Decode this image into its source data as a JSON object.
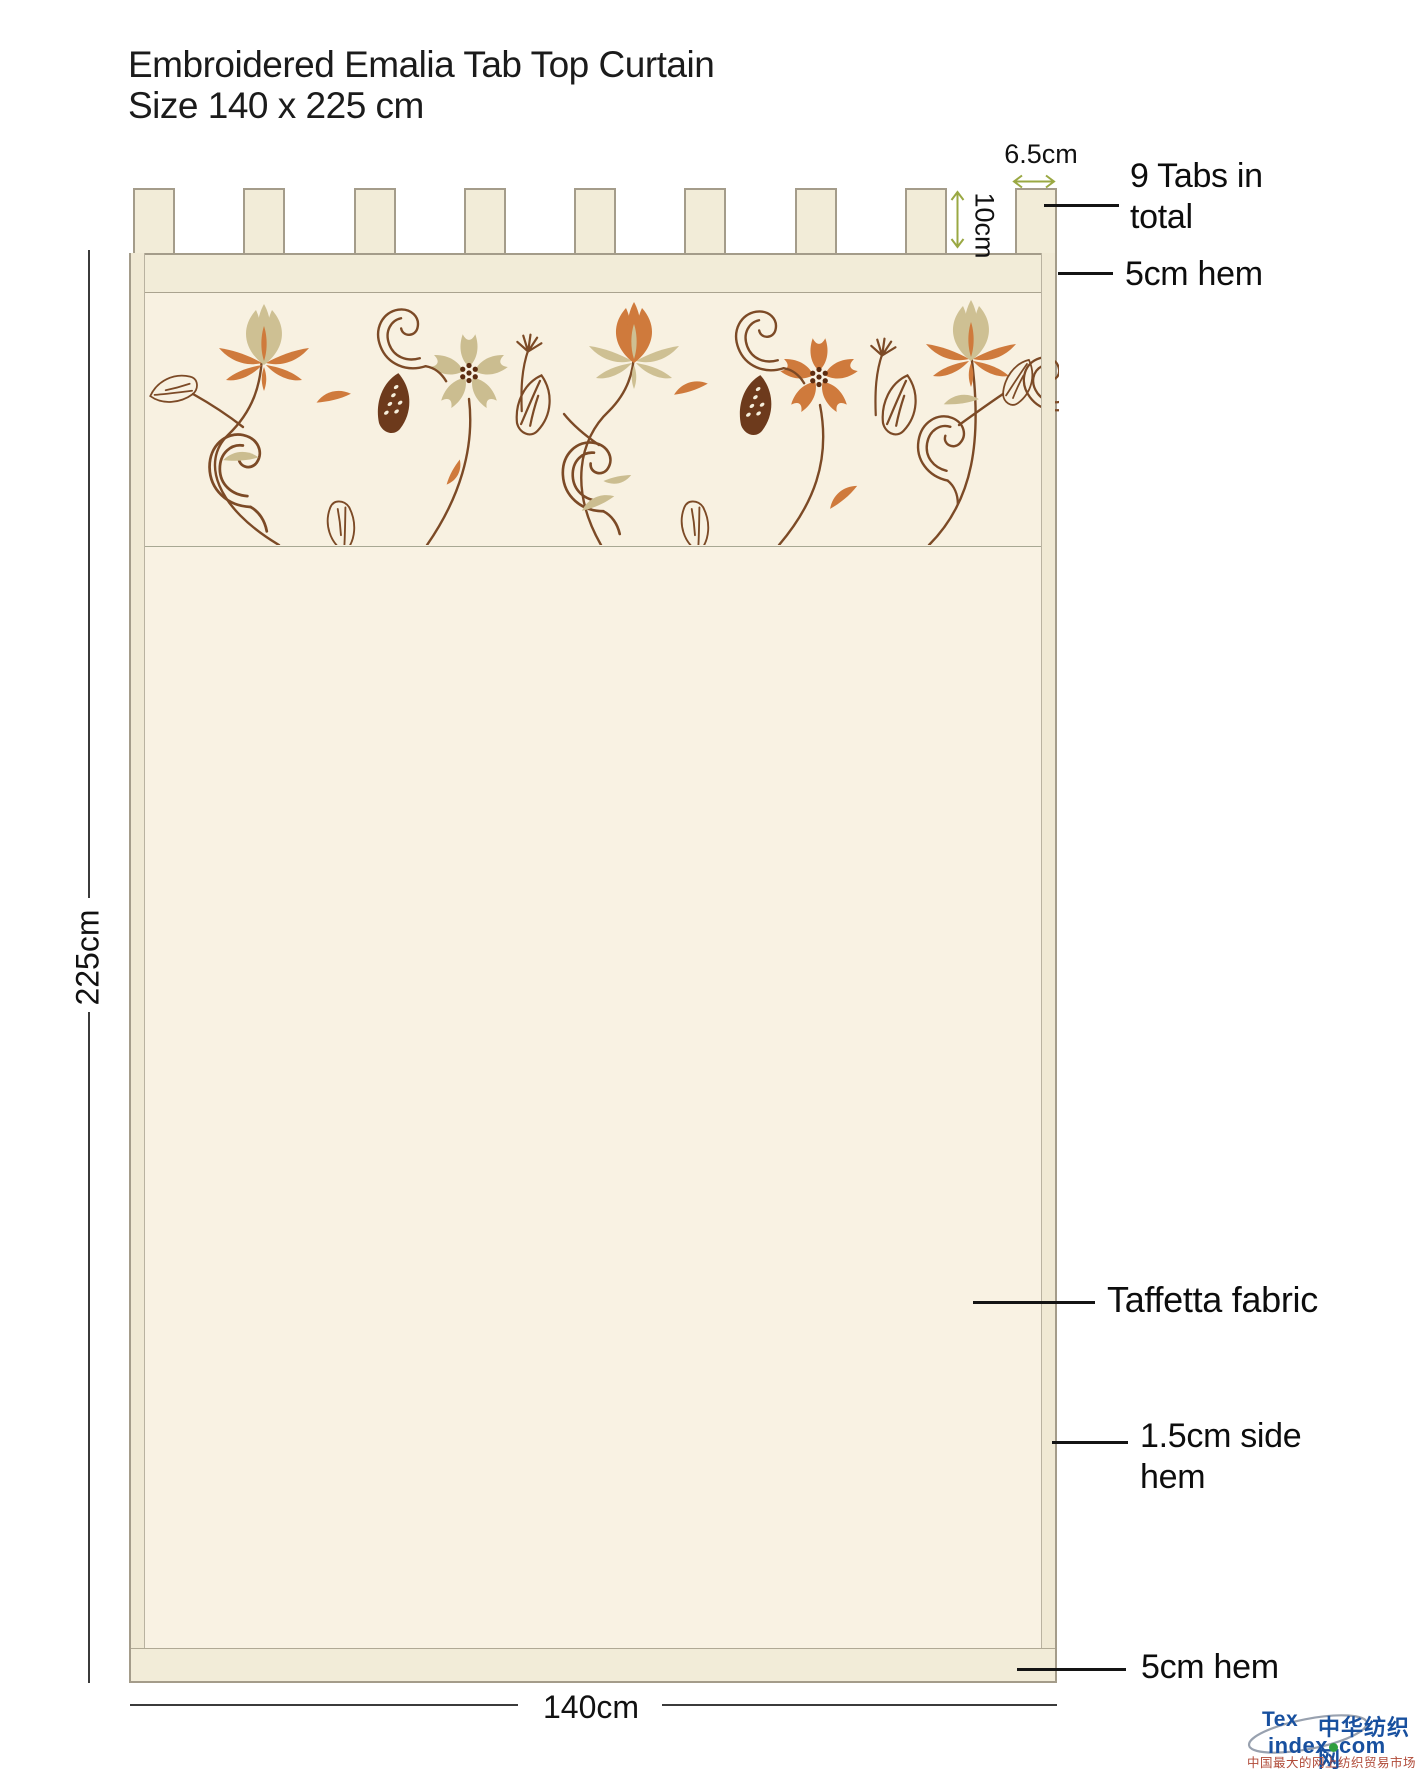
{
  "title": {
    "line1": "Embroidered Emalia Tab Top Curtain",
    "line2": "Size 140 x 225 cm"
  },
  "curtain": {
    "tab_count": 9
  },
  "dimensions": {
    "tab_width": "6.5cm",
    "tab_height": "10cm",
    "panel_height": "225cm",
    "panel_width": "140cm"
  },
  "callouts": {
    "tabs_total": "9 Tabs in total",
    "top_hem": "5cm hem",
    "fabric": "Taffetta fabric",
    "side_hem": "1.5cm side hem",
    "bottom_hem": "5cm hem"
  },
  "colors": {
    "fabric_body": "#f9f2e3",
    "fabric_trim": "#f2ecd8",
    "embroidery_bg": "#f8f1e1",
    "outline": "#a49c8a",
    "dimension_accent": "#9aa843",
    "embroidery_stem": "#7c4a26",
    "embroidery_orange": "#cf7a3c",
    "embroidery_tan": "#cec093",
    "logo_blue": "#18509f",
    "logo_green": "#2f9e3f",
    "logo_red": "#b04a38"
  },
  "logo": {
    "tex": "Tex",
    "index": "index",
    "com": "com",
    "cn_name": "中华纺织网",
    "tagline": "中国最大的网上纺织贸易市场"
  }
}
